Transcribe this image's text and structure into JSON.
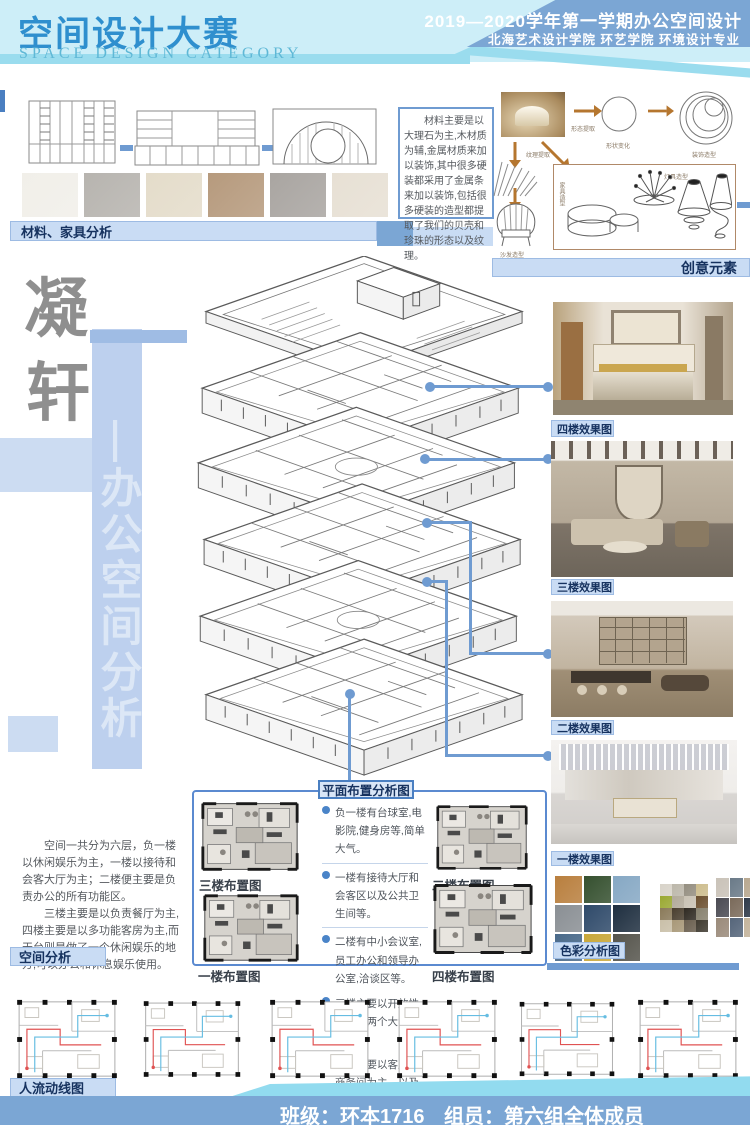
{
  "header": {
    "title": "空间设计大赛",
    "subtitle": "SPACE DESIGN CATEGORY",
    "right_line1": "2019—2020学年第一学期办公空间设计",
    "right_line2": "北海艺术设计学院  环艺学院  环境设计专业"
  },
  "materials": {
    "label": "材料、家具分析",
    "description": "材料主要是以大理石为主,木材质为辅,金属材质来加以装饰,其中很多硬装都采用了金属条来加以装饰,包括很多硬装的造型都提取了我们的贝壳和珍珠的形态以及纹理。",
    "swatches": [
      "#f1efe9",
      "#b7b4af",
      "#e4dcca",
      "#b69a7d",
      "#a9a5a1",
      "#e7e0d4"
    ]
  },
  "creative": {
    "label": "创意元素",
    "steps": [
      "形态提取",
      "形状变化",
      "装饰造型"
    ],
    "texture_label": "纹理提取",
    "sofa_label": "沙发造型",
    "lamp_label": "灯具造型",
    "furniture_label": "家具造型"
  },
  "title_block": {
    "name_char1": "凝",
    "name_char2": "轩",
    "vertical_text": "—办公空间分析"
  },
  "renders": {
    "floor4": "四楼效果图",
    "floor3": "三楼效果图",
    "floor2": "二楼效果图",
    "floor1": "一楼效果图"
  },
  "color_analysis": {
    "label": "色彩分析图",
    "photo_palette": [
      "#b97f3e",
      "#35502f",
      "#86a8c4",
      "#8a8f94",
      "#2f4a6a",
      "#1f2f40",
      "#4a6a8a",
      "#c9a83a",
      "#55544c"
    ],
    "tone_palette": [
      "#d8d3c9",
      "#bcb7aa",
      "#948e80",
      "#cdbd8e",
      "#9aa832",
      "#b2aa9a",
      "#c9c2b4",
      "#6b4f2f",
      "#8a7a5a",
      "#4a3f2f",
      "#2f2a22",
      "#87816f",
      "#c9bfa8",
      "#a89878",
      "#6a5f4f",
      "#3f3a30"
    ],
    "material_palette": [
      "#c9c2b8",
      "#6a7a88",
      "#b8a890",
      "#4a4a52",
      "#7a6a5a",
      "#2f3a4a",
      "#9a8a7a",
      "#55657a",
      "#c4b49c"
    ]
  },
  "plan_panel": {
    "title": "平面布置分析图",
    "bullets": [
      "负一楼有台球室,电影院,健身房等,简单大气。",
      "一楼有接待大厅和会客区以及公共卫生间等。",
      "二楼有中小会议室,员工办公和领导办公室,洽谈区等。",
      "三楼主要以开放性餐厅和两个大包间为主。",
      "四楼主要以客房和商务间为主，以及套房洗手间等。",
      "顶楼主要以休闲娱乐为主,可休息可办公。"
    ],
    "plan_labels": {
      "f3": "三楼布置图",
      "f2": "二楼布置图",
      "f1": "一楼布置图",
      "f4": "四楼布置图"
    }
  },
  "space_analysis": {
    "label": "空间分析",
    "para1": "空间一共分为六层，负一楼以休闲娱乐为主，一楼以接待和会客大厅为主；二楼便主要是负责办公的所有功能区。",
    "para2": "三楼主要是以负责餐厅为主,四楼主要是以多功能客房为主,而天台则是做了一个休闲娱乐的地方,可以办公和休息娱乐使用。"
  },
  "circulation": {
    "label": "人流动线图"
  },
  "footer": {
    "class_label": "班级：环本1716",
    "members_label": "组员：第六组全体成员"
  },
  "colors": {
    "accent_blue": "#6f9bd1",
    "label_bar_bg": "#c9dcf4",
    "navy_text": "#16325f",
    "header_blue": "#7ba6d4",
    "header_cyan": "#cdeef8"
  }
}
